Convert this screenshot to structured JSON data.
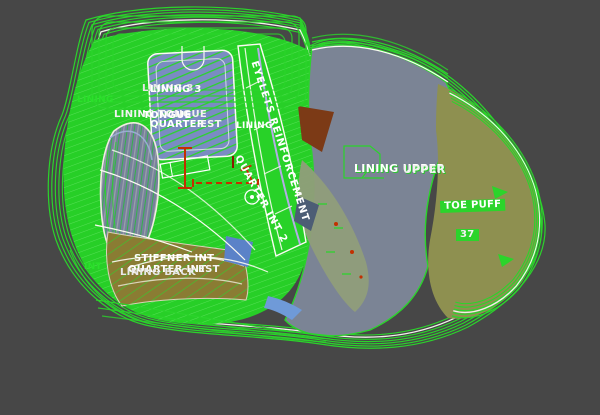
{
  "app": {
    "type": "footwear-pattern-cad-canvas",
    "background_color": "#474747"
  },
  "canvas": {
    "colors": {
      "outline_green": "#2bd42b",
      "fill_green": "#27cf27",
      "slate_blue": "#7b8495",
      "hatch_blue": "#7a8cc2",
      "teardrop_blue": "#76819b",
      "olive_toe": "#8e9050",
      "olive_heel": "#8a7c33",
      "sage_band": "#909d7a",
      "brown_patch": "#7c3a16",
      "lavender_line": "#b4abe6",
      "grading_red": "#c23000",
      "label_white": "#ffffff",
      "highlight_green": "#2bd42b"
    },
    "size_marker": "37",
    "labels": [
      {
        "id": "lining3-a",
        "text": "LINING 3",
        "x": 142,
        "y": 84,
        "rot": 0,
        "color": "#e6e6e6",
        "size": 10
      },
      {
        "id": "lining3-b",
        "text": "LINING 3",
        "x": 150,
        "y": 85,
        "rot": 0,
        "color": "#ffffff",
        "size": 10
      },
      {
        "id": "lining-green-fragment",
        "text": "LINING",
        "x": 77,
        "y": 96,
        "rot": 0,
        "color": "#2be02b",
        "size": 9
      },
      {
        "id": "lining-tongue-a",
        "text": "LINING TONGUE",
        "x": 114,
        "y": 110,
        "rot": 0,
        "color": "#f2f2f2",
        "size": 10
      },
      {
        "id": "lining-tongue-b",
        "text": "TONGUE",
        "x": 143,
        "y": 111,
        "rot": 0,
        "color": "#ffffff",
        "size": 10
      },
      {
        "id": "quarter",
        "text": "QUARTER",
        "x": 150,
        "y": 120,
        "rot": 0,
        "color": "#ffffff",
        "size": 10
      },
      {
        "id": "quarter-est",
        "text": "EST",
        "x": 200,
        "y": 120,
        "rot": 0,
        "color": "#f4f4f4",
        "size": 10
      },
      {
        "id": "lining-mid",
        "text": "LINING",
        "x": 236,
        "y": 122,
        "rot": 0,
        "color": "#ffffff",
        "size": 9
      },
      {
        "id": "eyelets-reinforcement",
        "text": "EYELETS REINFORCEMENT",
        "x": 258,
        "y": 60,
        "rot": 72,
        "color": "#ffffff",
        "size": 10,
        "spacing": 1
      },
      {
        "id": "quarter-int-2",
        "text": "QUARTER INT 2",
        "x": 241,
        "y": 154,
        "rot": 61,
        "color": "#ffffff",
        "size": 10,
        "spacing": 1
      },
      {
        "id": "lining-upper-a",
        "text": "LINING UPPER",
        "x": 354,
        "y": 163,
        "rot": 0,
        "color": "#ffffff",
        "size": 11,
        "glow": true
      },
      {
        "id": "lining-upper-b",
        "text": "UPPER",
        "x": 403,
        "y": 164,
        "rot": 0,
        "color": "#f0f0f0",
        "size": 11,
        "glow": true
      },
      {
        "id": "toe-puff",
        "text": "TOE PUFF",
        "x": 440,
        "y": 201,
        "rot": -2,
        "color": "#ffffff",
        "size": 10,
        "bg": "#2bd42b"
      },
      {
        "id": "size-37",
        "text": "37",
        "x": 456,
        "y": 229,
        "rot": 0,
        "color": "#f2f2f2",
        "size": 10,
        "bg": "#2bd42b"
      },
      {
        "id": "stiffner-int",
        "text": "STIFFNER INT",
        "x": 134,
        "y": 254,
        "rot": 0,
        "color": "#ffffff",
        "size": 10
      },
      {
        "id": "quarter-int",
        "text": "QUARTER INT",
        "x": 128,
        "y": 265,
        "rot": 0,
        "color": "#ffffff",
        "size": 10
      },
      {
        "id": "lining-back",
        "text": "LINING BACK",
        "x": 120,
        "y": 268,
        "rot": 0,
        "color": "#e8e8e8",
        "size": 10
      },
      {
        "id": "est-fragment",
        "text": "EST",
        "x": 198,
        "y": 265,
        "rot": 0,
        "color": "#f4f4f4",
        "size": 10
      },
      {
        "id": "left-green-fragment",
        "text": "INT",
        "x": 84,
        "y": 263,
        "rot": 0,
        "color": "#2be02b",
        "size": 9
      }
    ]
  }
}
